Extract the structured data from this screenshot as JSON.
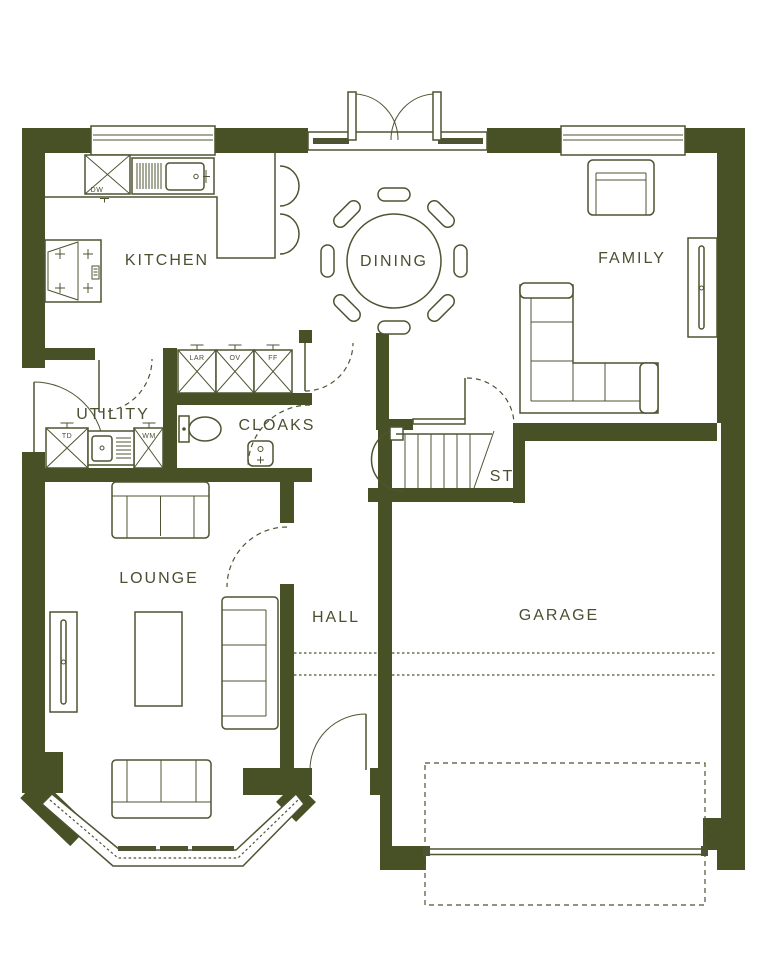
{
  "floorplan": {
    "rooms": {
      "kitchen": "KITCHEN",
      "dining": "DINING",
      "family": "FAMILY",
      "utility": "UTILITY",
      "cloaks": "CLOAKS",
      "stairs": "ST",
      "lounge": "LOUNGE",
      "hall": "HALL",
      "garage": "GARAGE"
    },
    "appliances": {
      "dishwasher": "DW",
      "larder": "LAR",
      "oven": "OV",
      "fridge_freezer": "FF",
      "tumble_dryer": "TD",
      "washing_machine": "WM"
    },
    "colors": {
      "wall": "#485026",
      "line": "#4e5431",
      "label": "#4a5030",
      "background": "#ffffff"
    }
  }
}
